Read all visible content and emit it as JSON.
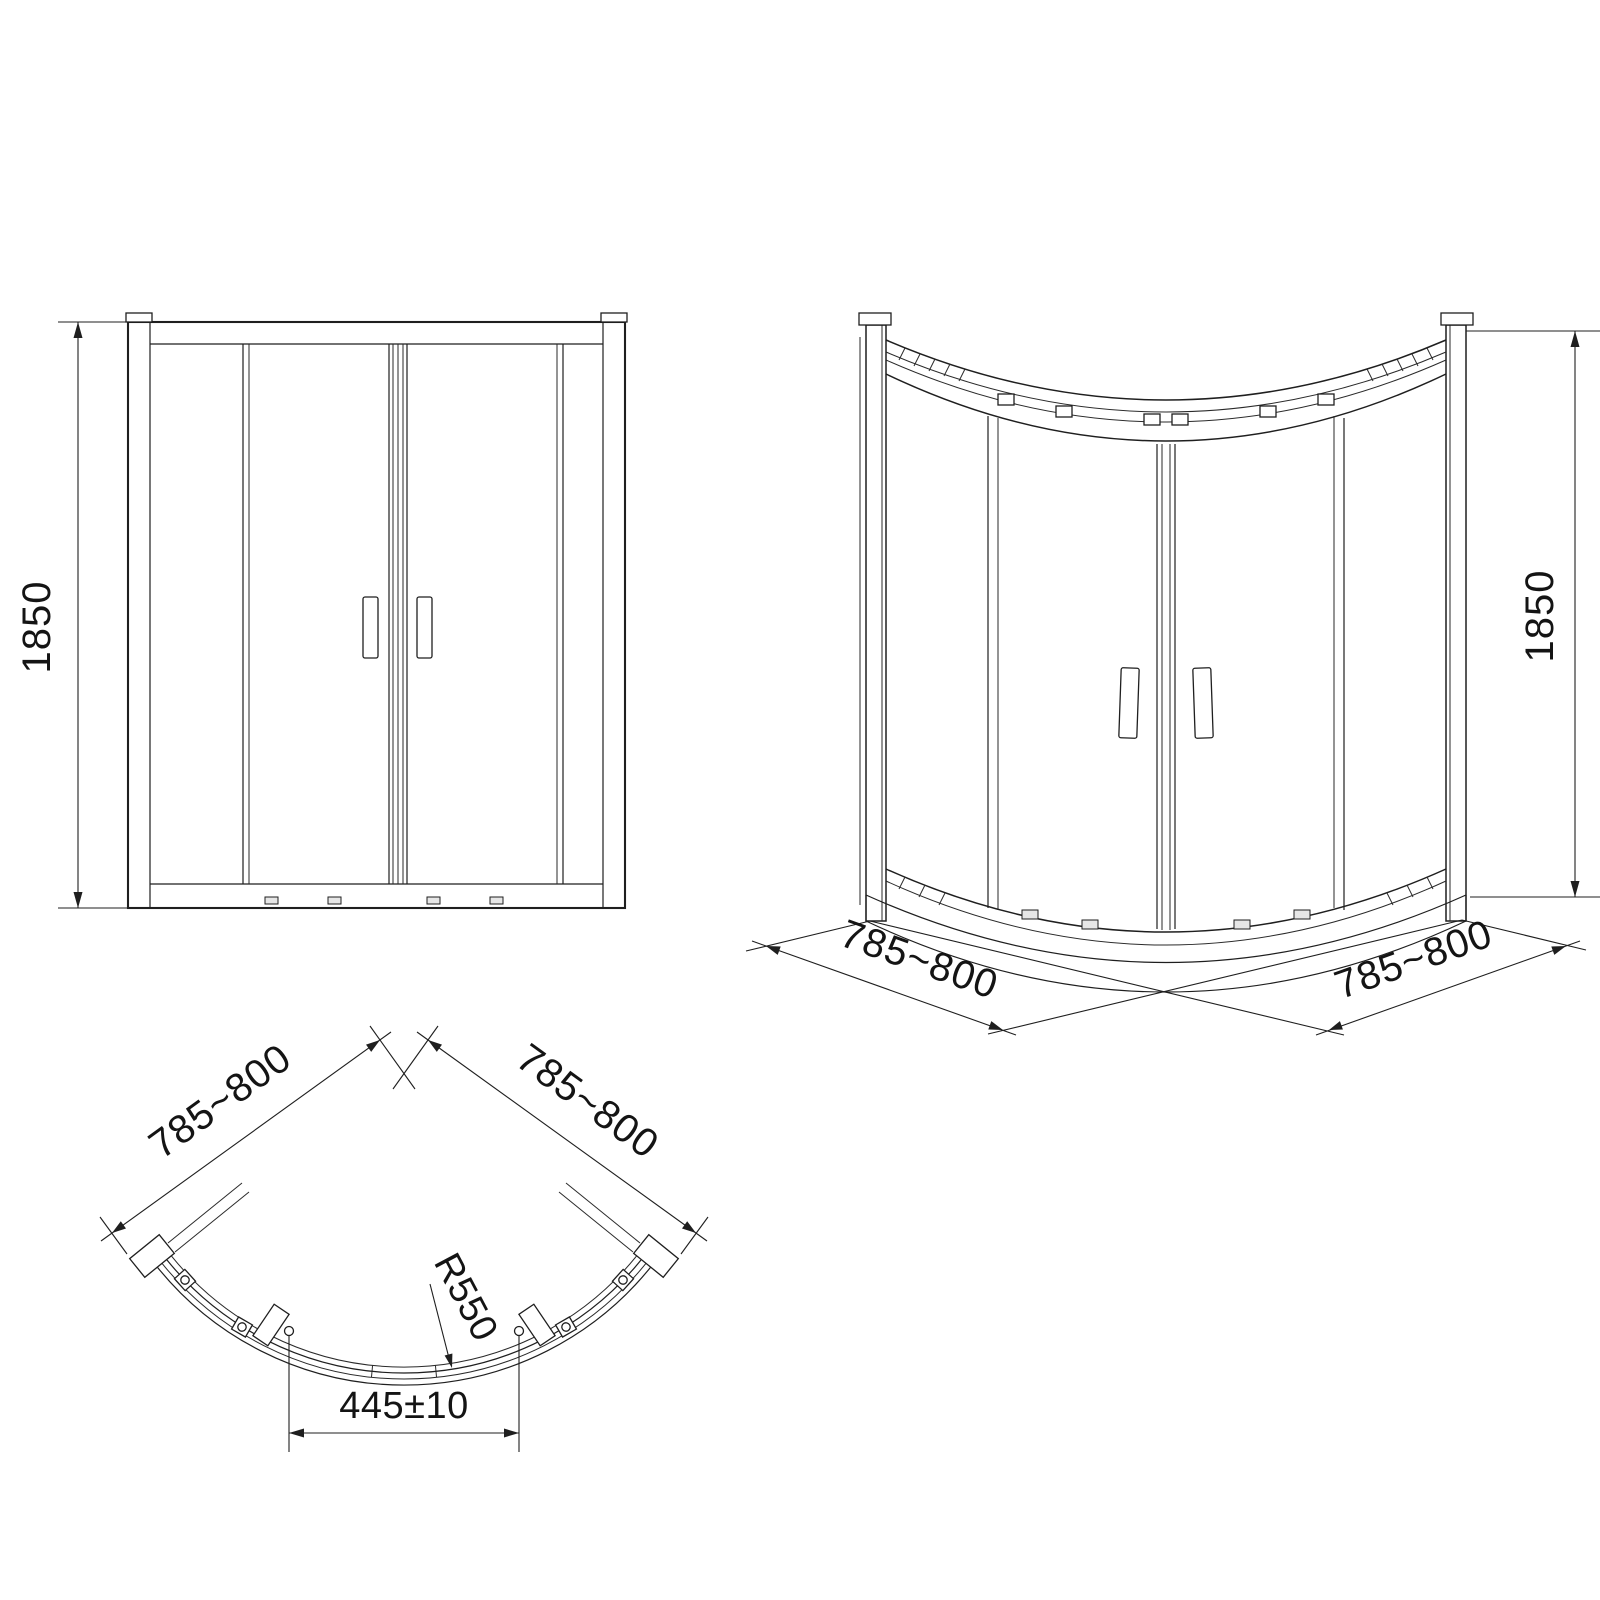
{
  "drawing": {
    "background": "#ffffff",
    "line_color": "#1f1f1f",
    "views": {
      "front_elevation": {
        "height_dimension": "1850"
      },
      "perspective": {
        "height_dimension": "1850",
        "left_base_dimension": "785~800",
        "right_base_dimension": "785~800"
      },
      "plan": {
        "left_side_dimension": "785~800",
        "right_side_dimension": "785~800",
        "radius_dimension": "R550",
        "entry_dimension": "445±10"
      }
    }
  }
}
